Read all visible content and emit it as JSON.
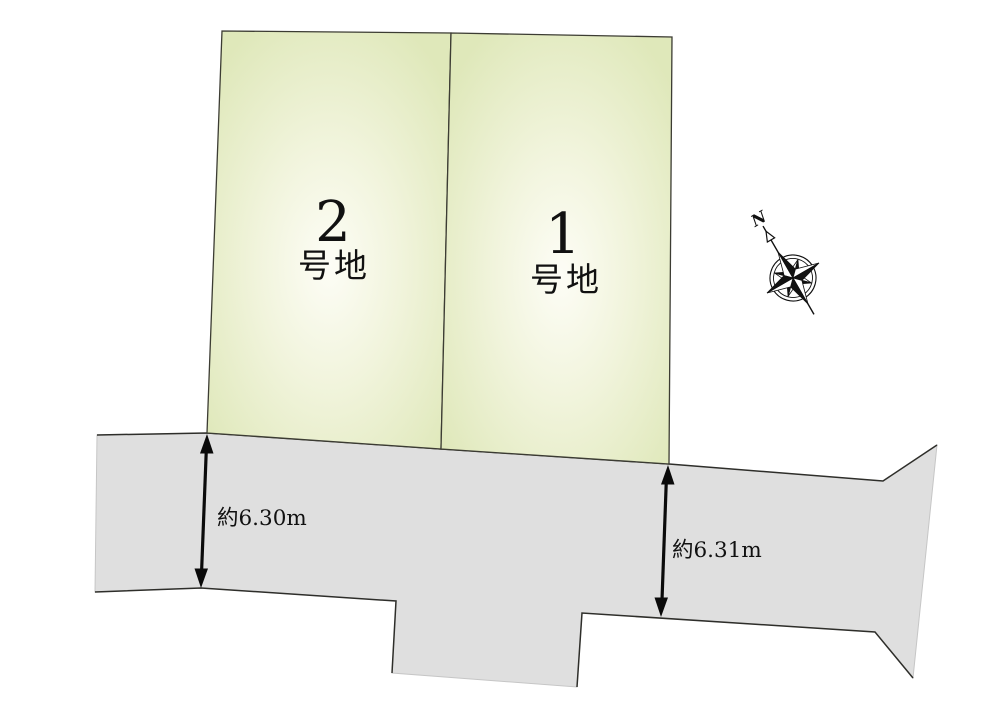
{
  "diagram": {
    "type": "land-plot-layout-plan",
    "plots": [
      {
        "number": "2",
        "suffix": "号地"
      },
      {
        "number": "1",
        "suffix": "号地"
      }
    ],
    "road": {
      "dimensions": [
        {
          "label": "約6.30m"
        },
        {
          "label": "約6.31m"
        }
      ]
    },
    "compass": {
      "north_label": "N"
    },
    "colors": {
      "plot_fill_center": "#fdfdf6",
      "plot_fill_mid": "#f1f4dc",
      "plot_fill_edge": "#dfe8ba",
      "plot_outline": "#3c3c33",
      "road_fill": "#dfdfdf",
      "road_outline": "#2e2e2a",
      "text": "#111111"
    }
  }
}
